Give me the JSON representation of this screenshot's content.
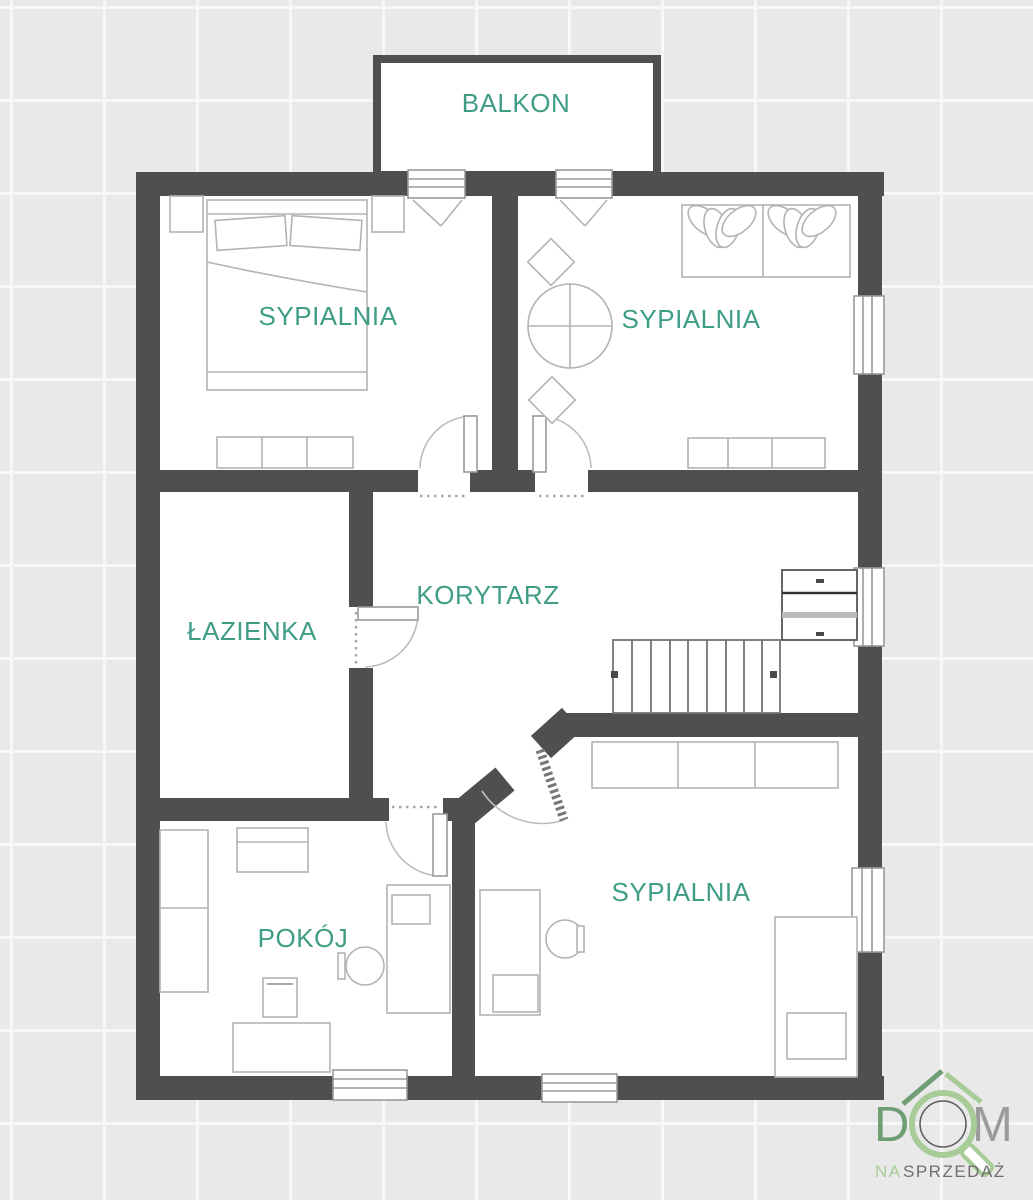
{
  "plan": {
    "type": "floor-plan",
    "rooms": {
      "balkon": "BALKON",
      "sypialnia_tl": "SYPIALNIA",
      "sypialnia_tr": "SYPIALNIA",
      "lazienka": "ŁAZIENKA",
      "korytarz": "KORYTARZ",
      "pokoj": "POKÓJ",
      "sypialnia_br": "SYPIALNIA"
    },
    "colors": {
      "wall": "#4f4f4f",
      "room_label": "#3f9d86",
      "background": "#e9e9e9",
      "grid_line": "#f7f7f7"
    }
  },
  "logo": {
    "d": "D",
    "m": "M",
    "na": "NA",
    "sprzedaz": "SPRZEDAŻ",
    "colors": {
      "dark_green": "#6f9e74",
      "light_green": "#a7cc98",
      "letter_gray": "#9b9b9b",
      "text_gray": "#6e6e6e"
    }
  }
}
